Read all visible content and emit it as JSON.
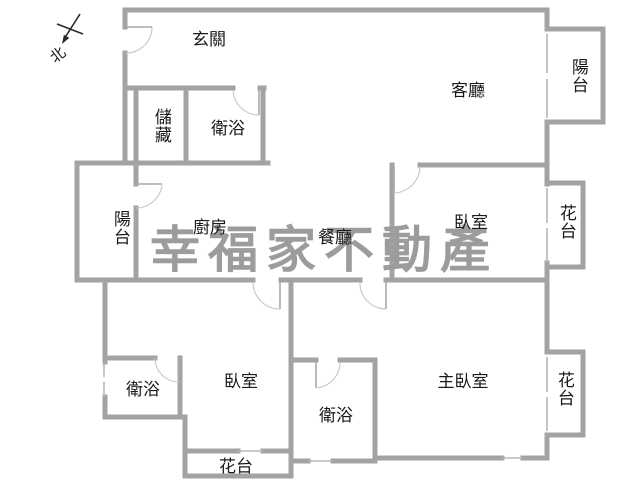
{
  "plan": {
    "watermark": "幸福家不動產",
    "north_label": "北",
    "colors": {
      "wall": "#a3a3a3",
      "watermark": "#9c9c9c",
      "label": "#1a1a1a"
    },
    "rooms": {
      "foyer": {
        "label": "玄關"
      },
      "living": {
        "label": "客廳"
      },
      "balcony_top_right": {
        "label": "陽台"
      },
      "storage": {
        "label": "儲藏"
      },
      "bath_top": {
        "label": "衛浴"
      },
      "balcony_left": {
        "label": "陽台"
      },
      "kitchen": {
        "label": "廚房"
      },
      "dining": {
        "label": "餐廳"
      },
      "bedroom_right": {
        "label": "臥室"
      },
      "flower_top_right": {
        "label": "花台"
      },
      "bath_left": {
        "label": "衛浴"
      },
      "bedroom_bottom": {
        "label": "臥室"
      },
      "bath_middle": {
        "label": "衛浴"
      },
      "master_bedroom": {
        "label": "主臥室"
      },
      "flower_bottom": {
        "label": "花台"
      },
      "flower_bottom_right": {
        "label": "花台"
      }
    }
  }
}
